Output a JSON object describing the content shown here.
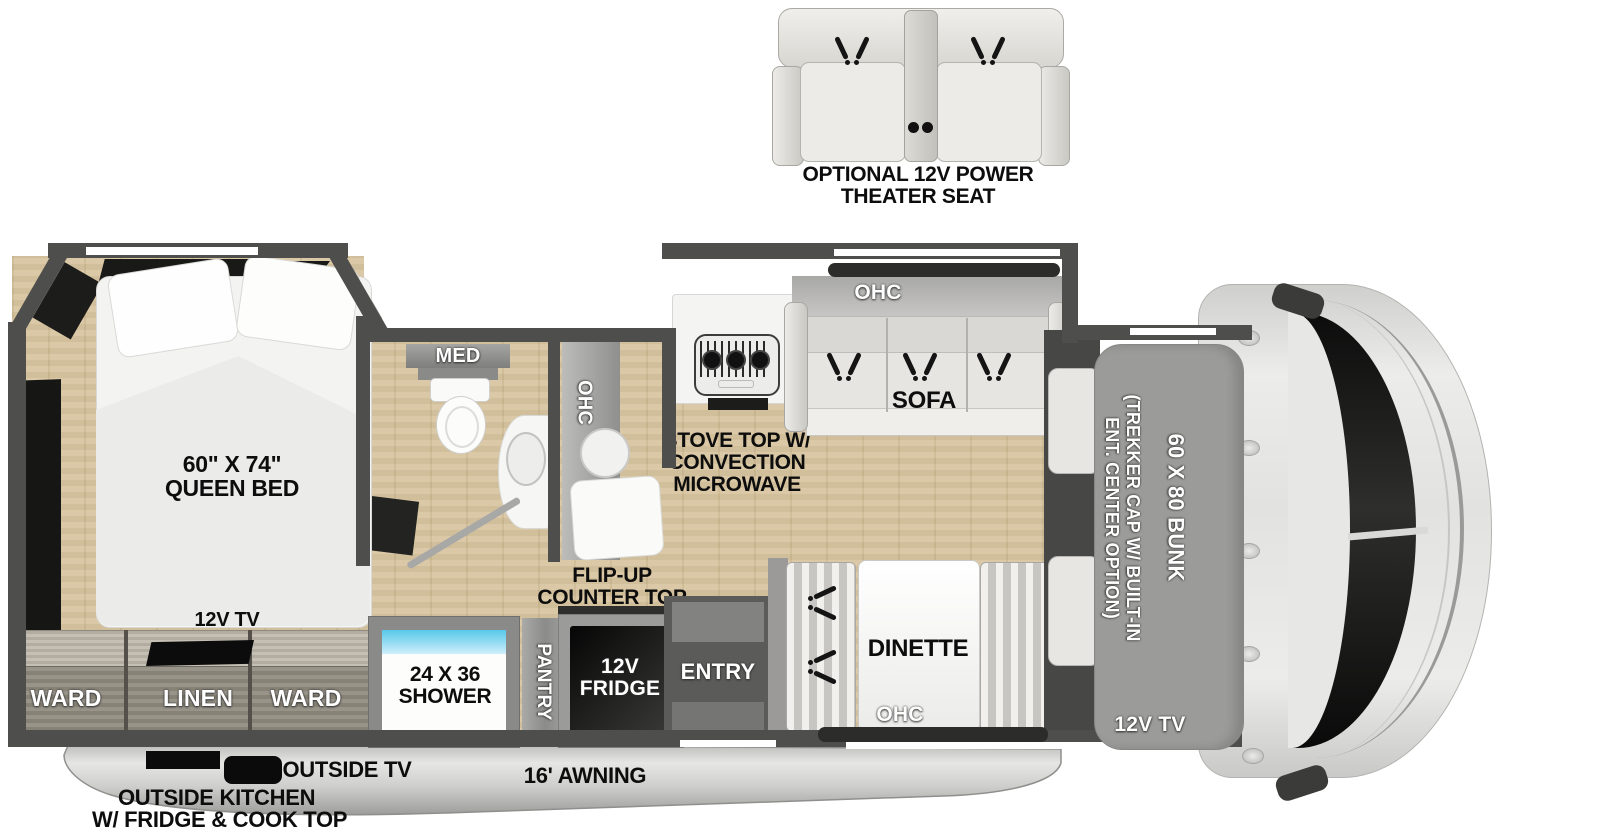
{
  "theater_seat": {
    "label_line1": "OPTIONAL 12V POWER",
    "label_line2": "THEATER SEAT"
  },
  "bedroom": {
    "bed_size": "60\" X 74\"",
    "bed_name": "QUEEN BED",
    "tv": "12V TV",
    "wardrobe_left": "WARD",
    "linen": "LINEN",
    "wardrobe_right": "WARD"
  },
  "bathroom": {
    "medicine_cabinet": "MED",
    "overhead_cabinet": "OHC",
    "shower_size": "24 X 36",
    "shower": "SHOWER"
  },
  "kitchen": {
    "stove_line1": "STOVE TOP W/",
    "stove_line2": "CONVECTION",
    "stove_line3": "MICROWAVE",
    "flip_counter_line1": "FLIP-UP",
    "flip_counter_line2": "COUNTER TOP",
    "pantry": "PANTRY",
    "fridge_line1": "12V",
    "fridge_line2": "FRIDGE"
  },
  "living": {
    "sofa": "SOFA",
    "sofa_overhead": "OHC",
    "dinette": "DINETTE",
    "dinette_overhead": "OHC",
    "entry": "ENTRY"
  },
  "cab": {
    "bunk_size": "60 X 80 BUNK",
    "bunk_option_line1": "(TREKKER CAP W/ BUILT-IN",
    "bunk_option_line2": "ENT. CENTER OPTION)",
    "tv": "12V TV"
  },
  "exterior": {
    "outside_tv": "OUTSIDE TV",
    "awning": "16' AWNING",
    "outside_kitchen_line1": "OUTSIDE KITCHEN",
    "outside_kitchen_line2": "W/ FRIDGE & COOK TOP"
  },
  "colors": {
    "wall": "#4e4e4c",
    "floor": "#d8c5a0",
    "shower_accent": "#56c9e9",
    "label": "#0d0d0d",
    "bunk_overlay": "#9b9b99"
  }
}
